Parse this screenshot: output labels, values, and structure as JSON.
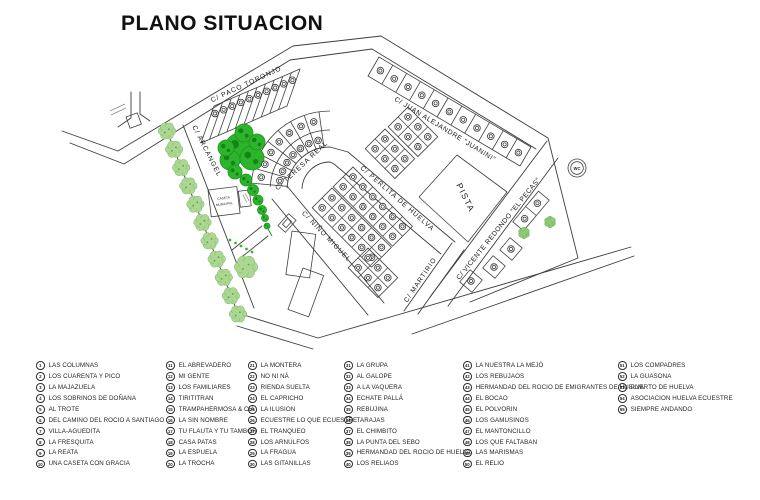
{
  "title": "PLANO SITUACION",
  "map": {
    "streets": {
      "paco_toronjo": "C/ PACO TORONJO",
      "juan_alejandre": "C/ JUAN ALEJANDRE \"JUANINI\"",
      "arcangel": "C/ ARCANGEL",
      "teresa_real": "C/ TERESA REAL",
      "perlita": "C/ PERLITA DE HUELVA",
      "nino_miguel": "C/ NIÑO MIGUEL",
      "martirio": "C/ MARTIRIO",
      "vicente_redondo": "C/ VICENTE REDONDO \"EL PECAS\""
    },
    "areas": {
      "pista": "PISTA",
      "caseta_line1": "CASETA",
      "caseta_line2": "MUNICIPAL",
      "wc": "WC"
    },
    "colors": {
      "vegetation_light": "#abd792",
      "vegetation_dark": "#2cb52c",
      "line": "#3d3d3d"
    }
  },
  "legend": {
    "items": [
      {
        "n": 1,
        "label": "LAS COLUMNAS"
      },
      {
        "n": 2,
        "label": "LOS CUARENTA Y PICO"
      },
      {
        "n": 3,
        "label": "LA MAJAZUELA"
      },
      {
        "n": 4,
        "label": "LOS SOBRINOS DE DOÑANA"
      },
      {
        "n": 5,
        "label": "AL TROTE"
      },
      {
        "n": 6,
        "label": "DEL CAMINO DEL ROCIO A SANTIAGO"
      },
      {
        "n": 7,
        "label": "VILLA-AGUEDITA"
      },
      {
        "n": 8,
        "label": "LA FRESQUITA"
      },
      {
        "n": 9,
        "label": "LA REATA"
      },
      {
        "n": 10,
        "label": "UNA CASETA CON GRACIA"
      },
      {
        "n": 11,
        "label": "EL ABREVADERO"
      },
      {
        "n": 12,
        "label": "MI GENTE"
      },
      {
        "n": 13,
        "label": "LOS FAMILIARES"
      },
      {
        "n": 14,
        "label": "TIRITITRAN"
      },
      {
        "n": 15,
        "label": "TRAMPAHERMOSA & CIA"
      },
      {
        "n": 16,
        "label": "LA SIN NOMBRE"
      },
      {
        "n": 17,
        "label": "TU FLAUTA Y TU TAMBOR"
      },
      {
        "n": 18,
        "label": "CASA PATAS"
      },
      {
        "n": 19,
        "label": "LA ESPUELA"
      },
      {
        "n": 20,
        "label": "LA TROCHA"
      },
      {
        "n": 21,
        "label": "LA MONTERA"
      },
      {
        "n": 22,
        "label": "NO NI NÁ"
      },
      {
        "n": 23,
        "label": "RIENDA SUELTA"
      },
      {
        "n": 24,
        "label": "EL CAPRICHO"
      },
      {
        "n": 25,
        "label": "LA ILUSION"
      },
      {
        "n": 26,
        "label": "ECUESTRE LO QUE ECUESTRE"
      },
      {
        "n": 27,
        "label": "EL TRANQUEO"
      },
      {
        "n": 28,
        "label": "LOS ARNULFOS"
      },
      {
        "n": 29,
        "label": "LA FRAGUA"
      },
      {
        "n": 30,
        "label": "LAS GITANILLAS"
      },
      {
        "n": 31,
        "label": "LA GRUPA"
      },
      {
        "n": 32,
        "label": "AL GALOPE"
      },
      {
        "n": 33,
        "label": "A LA VAQUERA"
      },
      {
        "n": 34,
        "label": "ECHATE PALLÁ"
      },
      {
        "n": 35,
        "label": "REBUJINA"
      },
      {
        "n": 36,
        "label": "TARAJAS"
      },
      {
        "n": 37,
        "label": "EL CHIMBITO"
      },
      {
        "n": 38,
        "label": "LA PUNTA DEL SEBO"
      },
      {
        "n": 39,
        "label": "HERMANDAD DEL ROCIO DE HUELVA"
      },
      {
        "n": 40,
        "label": "LOS RELIAOS"
      },
      {
        "n": 41,
        "label": "LA NUESTRA LA MEJÓ"
      },
      {
        "n": 42,
        "label": "LOS REBUJAOS"
      },
      {
        "n": 43,
        "label": "HERMANDAD DEL ROCIO DE EMIGRANTES DE HUELVA"
      },
      {
        "n": 44,
        "label": "EL BOCAO"
      },
      {
        "n": 45,
        "label": "EL POLVORIN"
      },
      {
        "n": 46,
        "label": "LOS GAMUSINOS"
      },
      {
        "n": 47,
        "label": "EL MANTONCILLO"
      },
      {
        "n": 48,
        "label": "LOS QUE FALTABAN"
      },
      {
        "n": 49,
        "label": "LAS MARISMAS"
      },
      {
        "n": 50,
        "label": "EL RELIO"
      },
      {
        "n": 51,
        "label": "LOS COMPADRES"
      },
      {
        "n": 52,
        "label": "LA GUASONA"
      },
      {
        "n": 53,
        "label": "PUERTO DE HUELVA"
      },
      {
        "n": 54,
        "label": "ASOCIACION HUELVA ECUESTRE"
      },
      {
        "n": 55,
        "label": "SIEMPRE ANDANDO"
      }
    ]
  }
}
